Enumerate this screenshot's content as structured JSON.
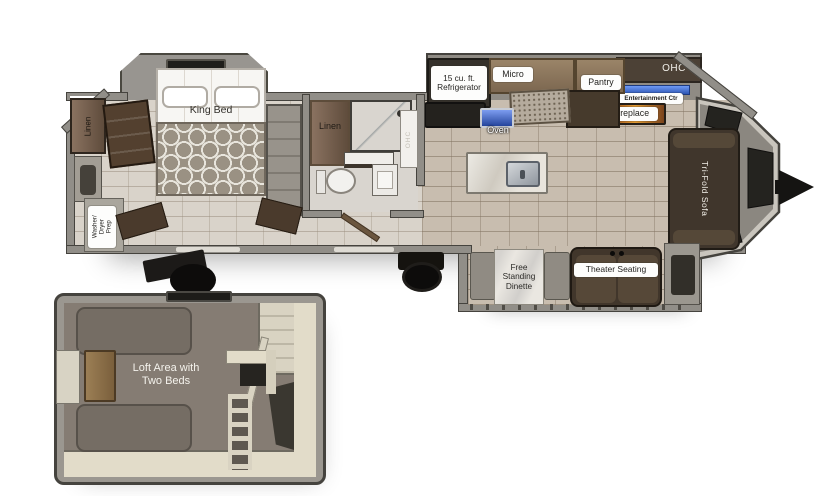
{
  "plan": {
    "bedroom": {
      "front_linen": "Linen",
      "king_bed": "King Bed",
      "washer_dryer": "Washer/\nDryer\nPrep"
    },
    "bathroom": {
      "linen": "Linen",
      "ohc": "OHC"
    },
    "kitchen": {
      "refrigerator": "15 cu. ft.\nRefrigerator",
      "micro": "Micro",
      "oven": "Oven",
      "pantry": "Pantry"
    },
    "living": {
      "ohc": "OHC",
      "entertainment": "Entertainment Ctr",
      "fireplace": "Fireplace",
      "sofa": "Tri-Fold Sofa",
      "dinette": "Free\nStanding\nDinette",
      "theater": "Theater Seating"
    },
    "loft": {
      "label": "Loft Area with\nTwo Beds"
    }
  },
  "colors": {
    "entertainment_blue": "#3d6fd6",
    "fireplace_orange": "#d98a2b",
    "wall_gray": "#918e88",
    "tile_tan": "#c8bdaf"
  }
}
